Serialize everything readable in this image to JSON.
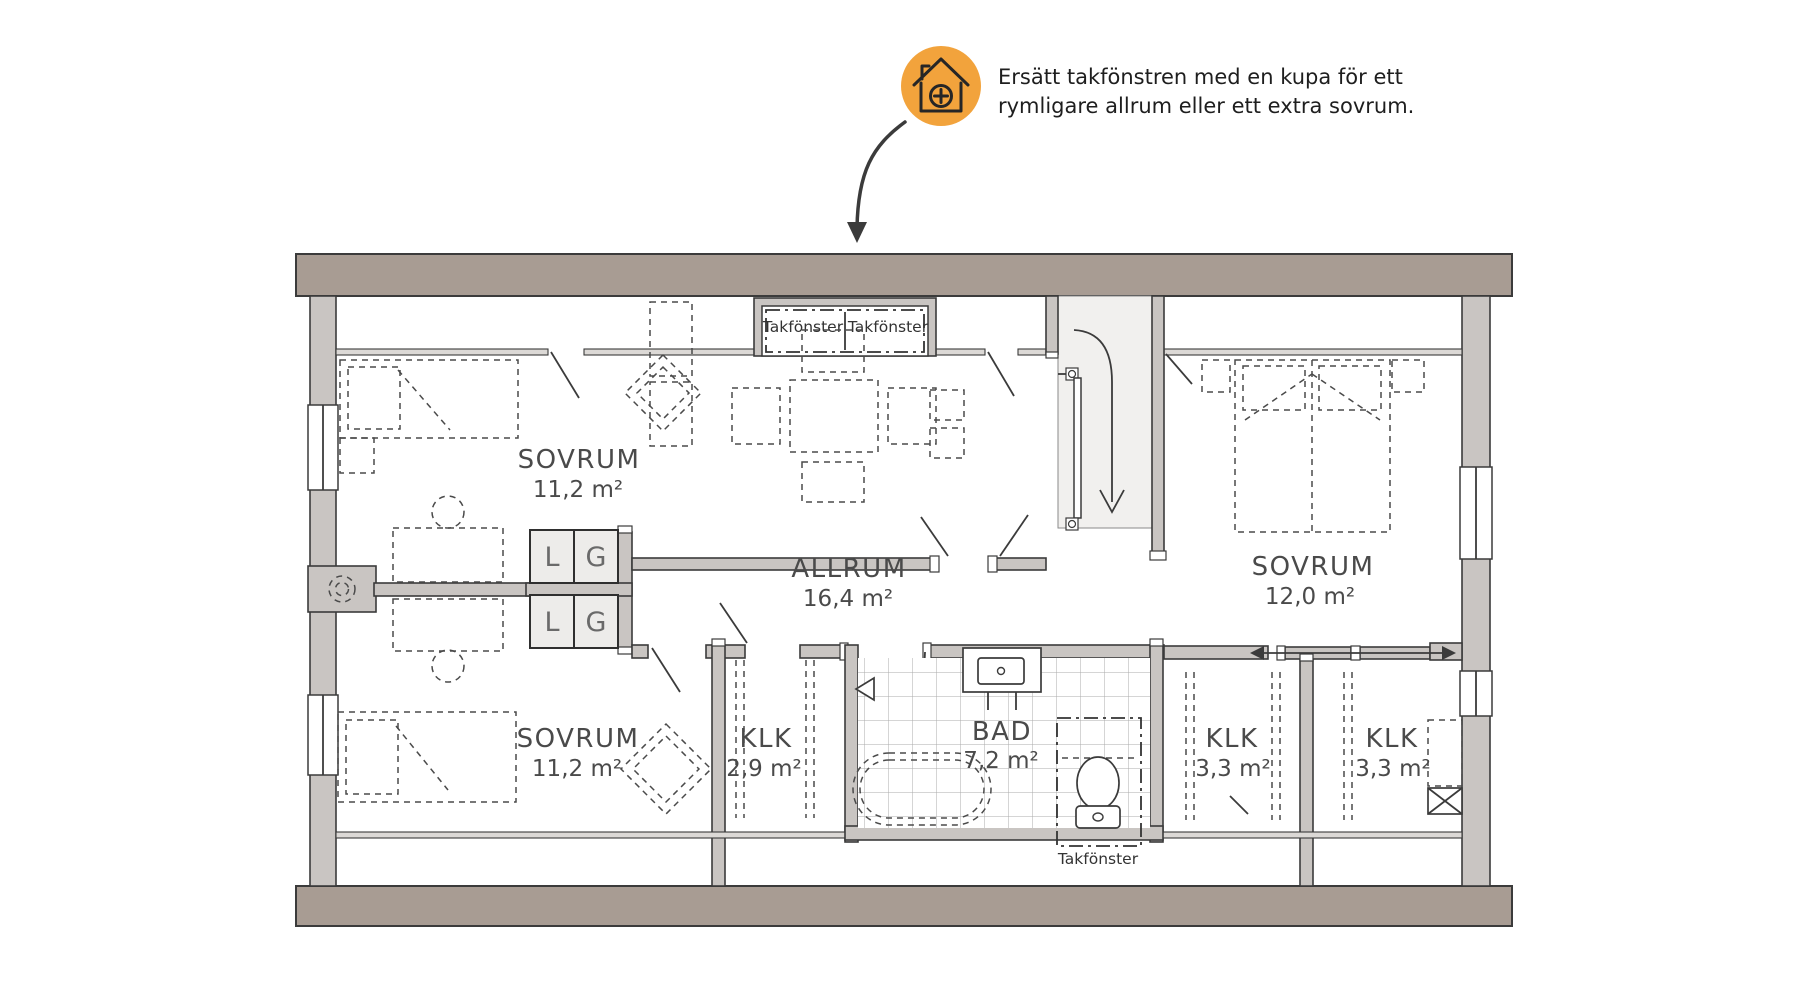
{
  "callout": {
    "icon": "house-add-icon",
    "text_line1": "Ersätt takfönstren med en kupa för ett",
    "text_line2": "rymligare allrum eller ett extra sovrum."
  },
  "rooms": {
    "sovrum_top_left": {
      "name": "SOVRUM",
      "area": "11,2 m²"
    },
    "sovrum_bottom_left": {
      "name": "SOVRUM",
      "area": "11,2 m²"
    },
    "allrum": {
      "name": "ALLRUM",
      "area": "16,4 m²"
    },
    "sovrum_right": {
      "name": "SOVRUM",
      "area": "12,0 m²"
    },
    "klk_small": {
      "name": "KLK",
      "area": "2,9 m²"
    },
    "bad": {
      "name": "BAD",
      "area": "7,2 m²"
    },
    "klk_right_1": {
      "name": "KLK",
      "area": "3,3 m²"
    },
    "klk_right_2": {
      "name": "KLK",
      "area": "3,3 m²"
    }
  },
  "skylights": {
    "top_left_label": "Takfönster",
    "top_right_label": "Takfönster",
    "bottom_label": "Takfönster"
  },
  "closets": {
    "linen_label": "L",
    "wardrobe_label": "G"
  },
  "colors": {
    "outer_wall": "#A89C93",
    "inner_wall": "#C9C5C2",
    "accent_orange": "#F2A33C",
    "line": "#3B3B3B",
    "text": "#4A4A4A"
  }
}
